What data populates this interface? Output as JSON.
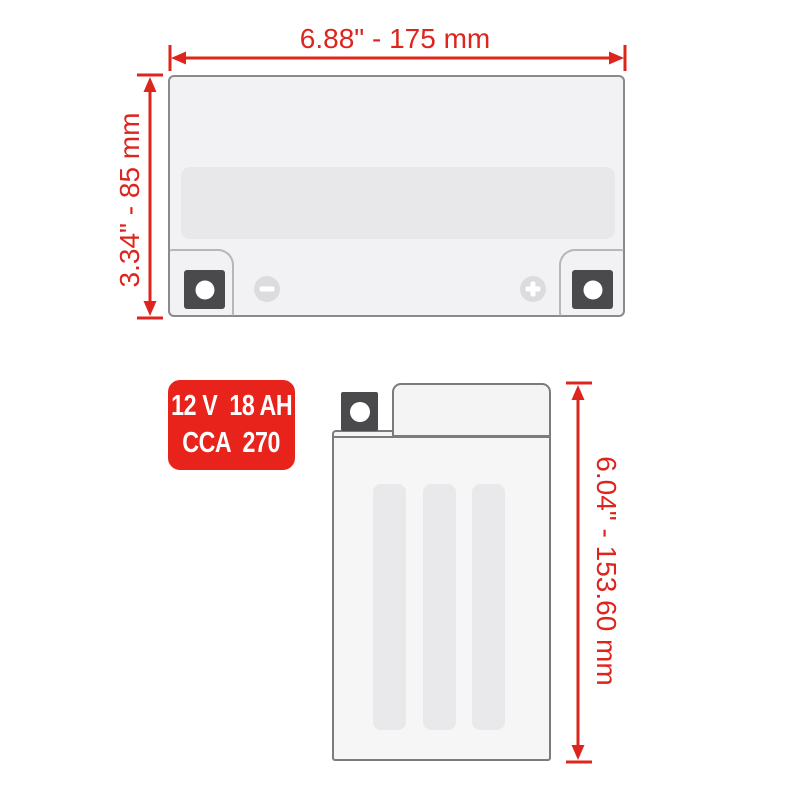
{
  "diagram": {
    "type": "battery-dimension-diagram",
    "views": {
      "front_view": "battery front view with terminals",
      "side_view": "battery side view"
    }
  },
  "dimensions": {
    "top_width": {
      "label": "6.88\" - 175 mm"
    },
    "front_height": {
      "label": "3.34\" - 85 mm"
    },
    "side_height": {
      "label": "6.04\" - 153.60 mm"
    }
  },
  "spec_badge": {
    "line1": "12 V  18 AH",
    "line2": "CCA  270"
  },
  "icons": {
    "negative_terminal": "minus-icon",
    "positive_terminal": "plus-icon"
  },
  "colors": {
    "dimension_red": "#dd241d",
    "spec_badge_red": "#e8231c",
    "terminal_gray": "#4a4a4d",
    "body_fill": "#f2f2f4",
    "label_band_fill": "#e8e8ea",
    "outline_gray": "#8a8a8e",
    "background": "#ffffff"
  }
}
